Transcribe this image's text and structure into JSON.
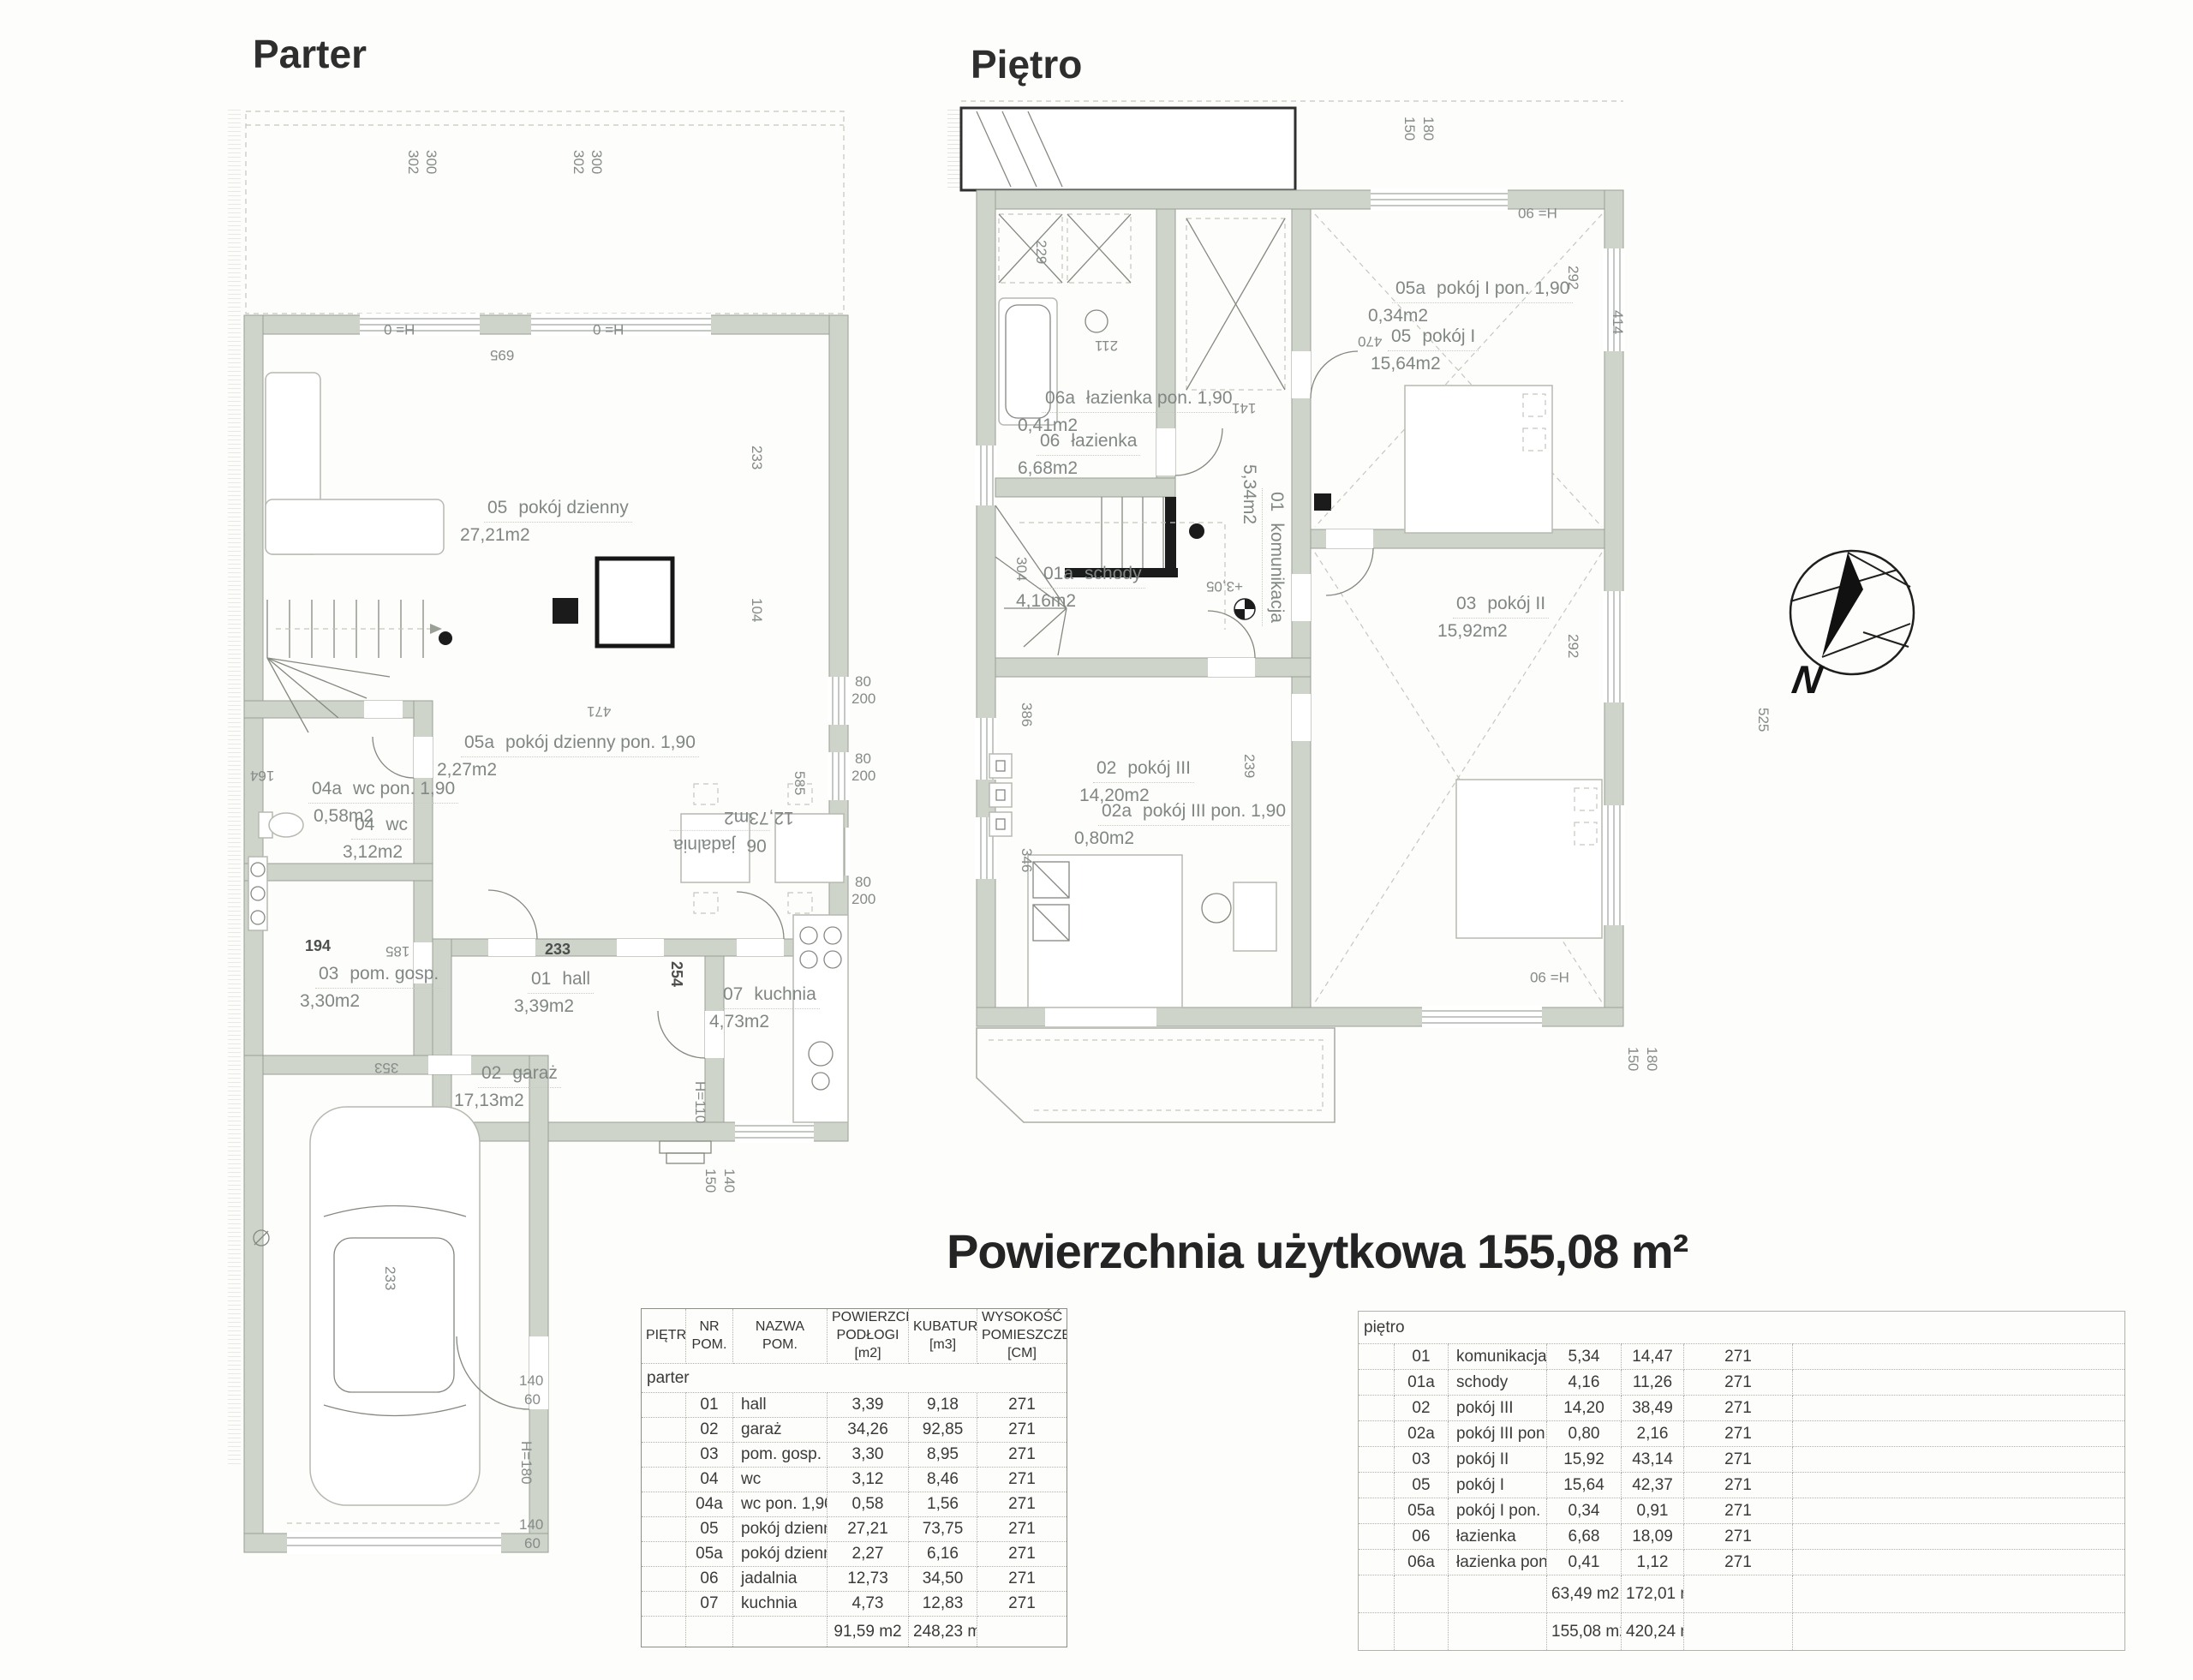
{
  "titles": {
    "parter": "Parter",
    "pietro": "Piętro",
    "main": "Powierzchnia użytkowa 155,08 m²"
  },
  "compass": {
    "north_label": "N"
  },
  "parter_plan": {
    "rooms": {
      "r05": {
        "code": "05",
        "name": "pokój dzienny",
        "area": "27,21m2"
      },
      "r05a": {
        "code": "05a",
        "name": "pokój dzienny pon. 1,90",
        "area": "2,27m2"
      },
      "r04a": {
        "code": "04a",
        "name": "wc pon. 1,90",
        "area": "0,58m2"
      },
      "r04": {
        "code": "04",
        "name": "wc",
        "area": "3,12m2"
      },
      "r03": {
        "code": "03",
        "name": "pom. gosp.",
        "area": "3,30m2"
      },
      "r01": {
        "code": "01",
        "name": "hall",
        "area": "3,39m2"
      },
      "r07": {
        "code": "07",
        "name": "kuchnia",
        "area": "4,73m2"
      },
      "r06": {
        "code": "06",
        "name": "jadalnia",
        "area": "12,73m2"
      },
      "r02": {
        "code": "02",
        "name": "garaż",
        "area": "17,13m2"
      }
    },
    "dims": [
      "302",
      "300",
      "302",
      "300",
      "H= 0",
      "H= 0",
      "695",
      "233",
      "104",
      "471",
      "585",
      "164",
      "194",
      "185",
      "233",
      "254",
      "353",
      "233",
      "80",
      "200",
      "80",
      "200",
      "80",
      "200",
      "H=110",
      "150",
      "140",
      "140",
      "60",
      "H=180",
      "140",
      "60"
    ]
  },
  "pietro_plan": {
    "rooms": {
      "r05a": {
        "code": "05a",
        "name": "pokój I pon. 1,90",
        "area": "0,34m2"
      },
      "r05": {
        "code": "05",
        "name": "pokój I",
        "area": "15,64m2"
      },
      "r06a": {
        "code": "06a",
        "name": "łazienka pon. 1,90",
        "area": "0,41m2"
      },
      "r06": {
        "code": "06",
        "name": "łazienka",
        "area": "6,68m2"
      },
      "r01a": {
        "code": "01a",
        "name": "schody",
        "area": "4,16m2"
      },
      "r01": {
        "code": "01",
        "name": "komunikacja",
        "area": "5,34m2"
      },
      "r03": {
        "code": "03",
        "name": "pokój II",
        "area": "15,92m2"
      },
      "r02": {
        "code": "02",
        "name": "pokój III",
        "area": "14,20m2"
      },
      "r02a": {
        "code": "02a",
        "name": "pokój III pon. 1,90",
        "area": "0,80m2"
      }
    },
    "dims": [
      "150",
      "180",
      "H= 90",
      "229",
      "211",
      "470",
      "414",
      "292",
      "141",
      "304",
      "+3,05",
      "292",
      "386",
      "239",
      "525",
      "346",
      "H= 90",
      "150",
      "180"
    ]
  },
  "tables": {
    "parter": {
      "headers": [
        "PIĘTRO",
        "NR POM.",
        "NAZWA POM.",
        "POWIERZCHNIA\nPODŁOGI [m2]",
        "KUBATURA\n[m3]",
        "WYSOKOŚĆ\nPOMIESZCZENIA [CM]"
      ],
      "section": "parter",
      "rows": [
        [
          "01",
          "hall",
          "3,39",
          "9,18",
          "271"
        ],
        [
          "02",
          "garaż",
          "34,26",
          "92,85",
          "271"
        ],
        [
          "03",
          "pom. gosp.",
          "3,30",
          "8,95",
          "271"
        ],
        [
          "04",
          "wc",
          "3,12",
          "8,46",
          "271"
        ],
        [
          "04a",
          "wc pon. 1,90",
          "0,58",
          "1,56",
          "271"
        ],
        [
          "05",
          "pokój dzienny",
          "27,21",
          "73,75",
          "271"
        ],
        [
          "05a",
          "pokój dzienny pon. 1,90",
          "2,27",
          "6,16",
          "271"
        ],
        [
          "06",
          "jadalnia",
          "12,73",
          "34,50",
          "271"
        ],
        [
          "07",
          "kuchnia",
          "4,73",
          "12,83",
          "271"
        ]
      ],
      "total_m2": "91,59 m2",
      "total_m3": "248,23 m3"
    },
    "pietro": {
      "section": "piętro",
      "rows": [
        [
          "01",
          "komunikacja",
          "5,34",
          "14,47",
          "271"
        ],
        [
          "01a",
          "schody",
          "4,16",
          "11,26",
          "271"
        ],
        [
          "02",
          "pokój III",
          "14,20",
          "38,49",
          "271"
        ],
        [
          "02a",
          "pokój III pon. 1,90",
          "0,80",
          "2,16",
          "271"
        ],
        [
          "03",
          "pokój II",
          "15,92",
          "43,14",
          "271"
        ],
        [
          "05",
          "pokój I",
          "15,64",
          "42,37",
          "271"
        ],
        [
          "05a",
          "pokój I pon. 1,90",
          "0,34",
          "0,91",
          "271"
        ],
        [
          "06",
          "łazienka",
          "6,68",
          "18,09",
          "271"
        ],
        [
          "06a",
          "łazienka pon. 1,90",
          "0,41",
          "1,12",
          "271"
        ]
      ],
      "subtotal_m2": "63,49 m2",
      "subtotal_m3": "172,01 m3",
      "total_m2": "155,08 m2",
      "total_m3": "420,24 m3"
    }
  }
}
